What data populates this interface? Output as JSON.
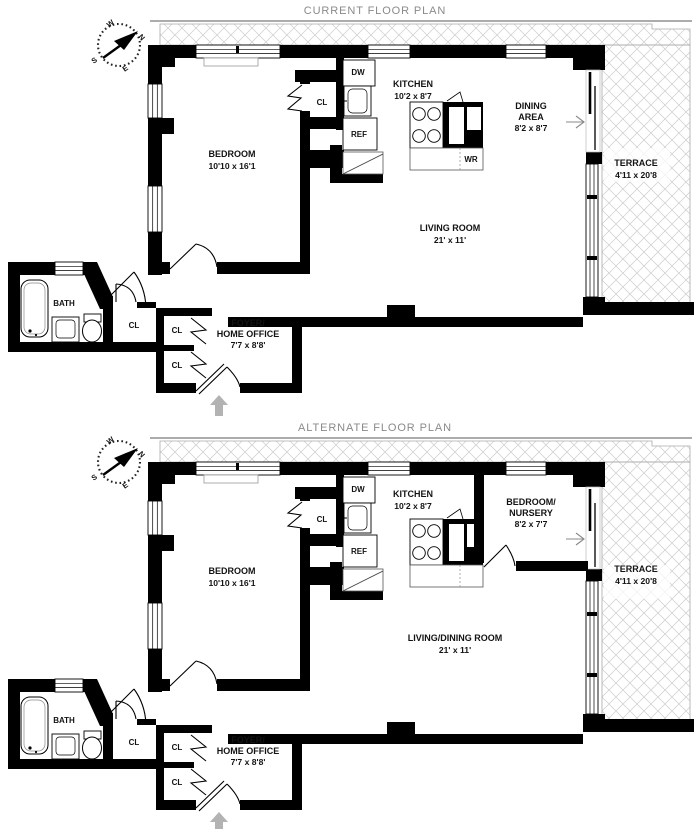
{
  "compass": {
    "n": "N",
    "s": "S",
    "e": "E",
    "w": "W"
  },
  "colors": {
    "wall": "#000000",
    "hatch_line": "#cccccc",
    "title_text": "#8a8a8a",
    "entry_arrow": "#b3b3b3",
    "label_text": "#131313"
  },
  "plans": {
    "current": {
      "title": "CURRENT FLOOR PLAN",
      "rooms": {
        "bedroom": {
          "name": "BEDROOM",
          "dims": "10'10 x 16'1"
        },
        "kitchen": {
          "name": "KITCHEN",
          "dims": "10'2 x 8'7"
        },
        "dining": {
          "line1": "DINING",
          "line2": "AREA",
          "dims": "8'2 x 8'7"
        },
        "living": {
          "name": "LIVING ROOM",
          "dims": "21' x 11'"
        },
        "terrace": {
          "name": "TERRACE",
          "dims": "4'11 x 20'8"
        },
        "bath": {
          "name": "BATH"
        },
        "foyer": {
          "line1": "FOYER/",
          "line2": "HOME OFFICE",
          "dims": "7'7 x 8'8'"
        }
      },
      "labels": {
        "closet": "CL",
        "dishwasher": "DW",
        "refrigerator": "REF",
        "washer": "WR"
      }
    },
    "alternate": {
      "title": "ALTERNATE FLOOR PLAN",
      "rooms": {
        "bedroom": {
          "name": "BEDROOM",
          "dims": "10'10 x 16'1"
        },
        "kitchen": {
          "name": "KITCHEN",
          "dims": "10'2 x 8'7"
        },
        "nursery": {
          "line1": "BEDROOM/",
          "line2": "NURSERY",
          "dims": "8'2 x 7'7"
        },
        "living": {
          "name": "LIVING/DINING ROOM",
          "dims": "21' x 11'"
        },
        "terrace": {
          "name": "TERRACE",
          "dims": "4'11 x 20'8"
        },
        "bath": {
          "name": "BATH"
        },
        "foyer": {
          "line1": "FOYER/",
          "line2": "HOME OFFICE",
          "dims": "7'7 x 8'8'"
        }
      },
      "labels": {
        "closet": "CL",
        "dishwasher": "DW",
        "refrigerator": "REF"
      }
    }
  }
}
